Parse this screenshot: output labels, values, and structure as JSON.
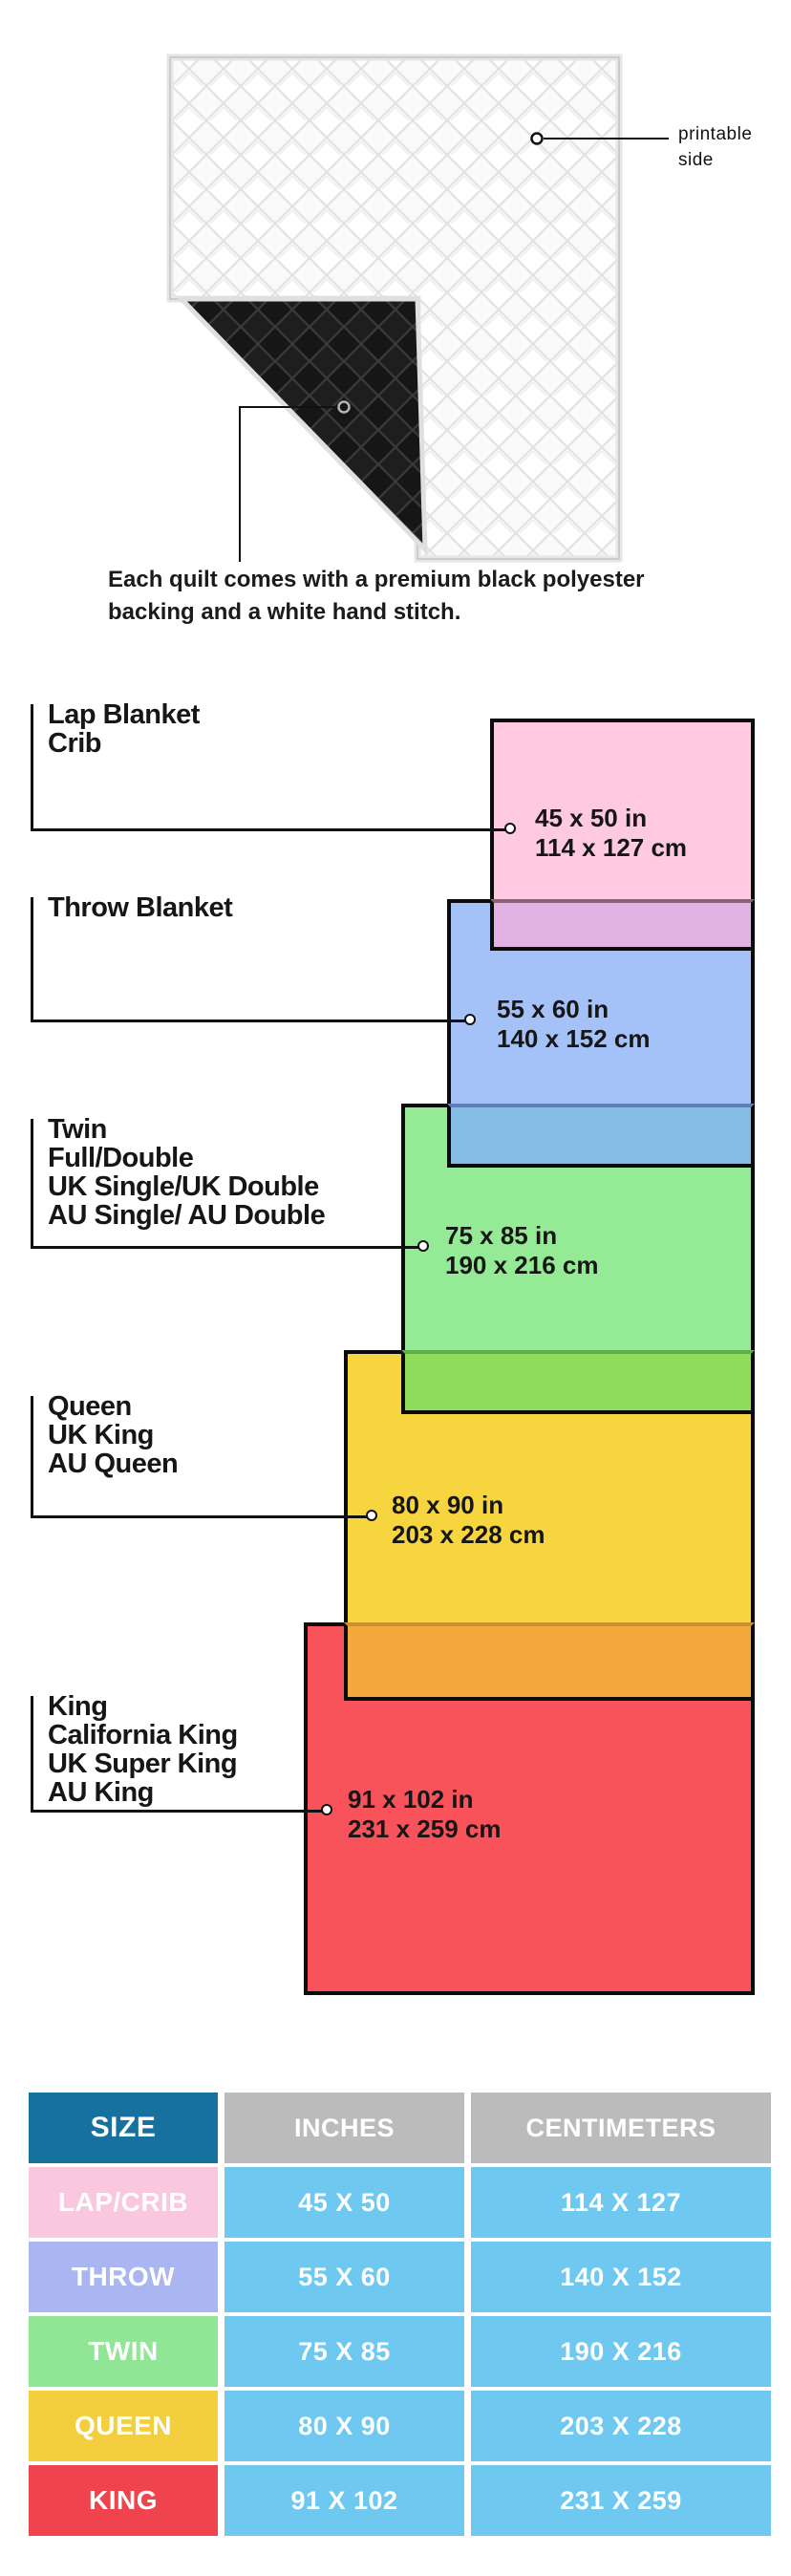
{
  "hero": {
    "printable_side": "printable side",
    "caption_line1": "Each quilt comes with a premium black polyester",
    "caption_line2": "backing and a white hand stitch.",
    "quilt_front_color": "#fafafa",
    "quilt_back_color": "#181818"
  },
  "diagram": {
    "sizes": [
      {
        "name": "lap-crib",
        "label_lines": [
          "Lap Blanket",
          "Crib"
        ],
        "inches": "45 x 50 in",
        "cm": "114 x 127 cm",
        "fill": "#FFC9E0"
      },
      {
        "name": "throw",
        "label_lines": [
          "Throw Blanket"
        ],
        "inches": "55 x 60 in",
        "cm": "140 x 152 cm",
        "fill": "#A4C2F8"
      },
      {
        "name": "twin",
        "label_lines": [
          "Twin",
          "Full/Double",
          "UK Single/UK Double",
          "AU Single/ AU Double"
        ],
        "inches": "75 x 85 in",
        "cm": "190 x 216 cm",
        "fill": "#95EB95"
      },
      {
        "name": "queen",
        "label_lines": [
          "Queen",
          "UK King",
          "AU Queen"
        ],
        "inches": "80 x 90 in",
        "cm": "203 x 228 cm",
        "fill": "#F6D53F"
      },
      {
        "name": "king",
        "label_lines": [
          "King",
          "California King",
          "UK Super King",
          "AU King"
        ],
        "inches": "91 x 102 in",
        "cm": "231 x 259 cm",
        "fill": "#F8525A"
      }
    ],
    "overlaps": [
      {
        "name": "lap-over-throw",
        "fill": "#E2B2E2"
      },
      {
        "name": "throw-over-twin",
        "fill": "#85BCE3"
      },
      {
        "name": "twin-over-queen",
        "fill": "#8FDC5C"
      },
      {
        "name": "queen-over-king",
        "fill": "#F5A93C"
      }
    ]
  },
  "table": {
    "headers": [
      "SIZE",
      "INCHES",
      "CENTIMETERS"
    ],
    "header_size_fill": "#17719E",
    "header_gray_fill": "#BBBBBB",
    "value_cell_fill": "#6EC8F0",
    "rows": [
      {
        "size": "LAP/CRIB",
        "inches": "45 X 50",
        "cm": "114 X 127",
        "fill": "#F9C8DE"
      },
      {
        "size": "THROW",
        "inches": "55 X 60",
        "cm": "140 X 152",
        "fill": "#AAB6F2"
      },
      {
        "size": "TWIN",
        "inches": "75 X 85",
        "cm": "190 X 216",
        "fill": "#90E694"
      },
      {
        "size": "QUEEN",
        "inches": "80 X 90",
        "cm": "203 X 228",
        "fill": "#F3CE3F"
      },
      {
        "size": "KING",
        "inches": "91 X 102",
        "cm": "231 X 259",
        "fill": "#EF434E"
      }
    ]
  }
}
